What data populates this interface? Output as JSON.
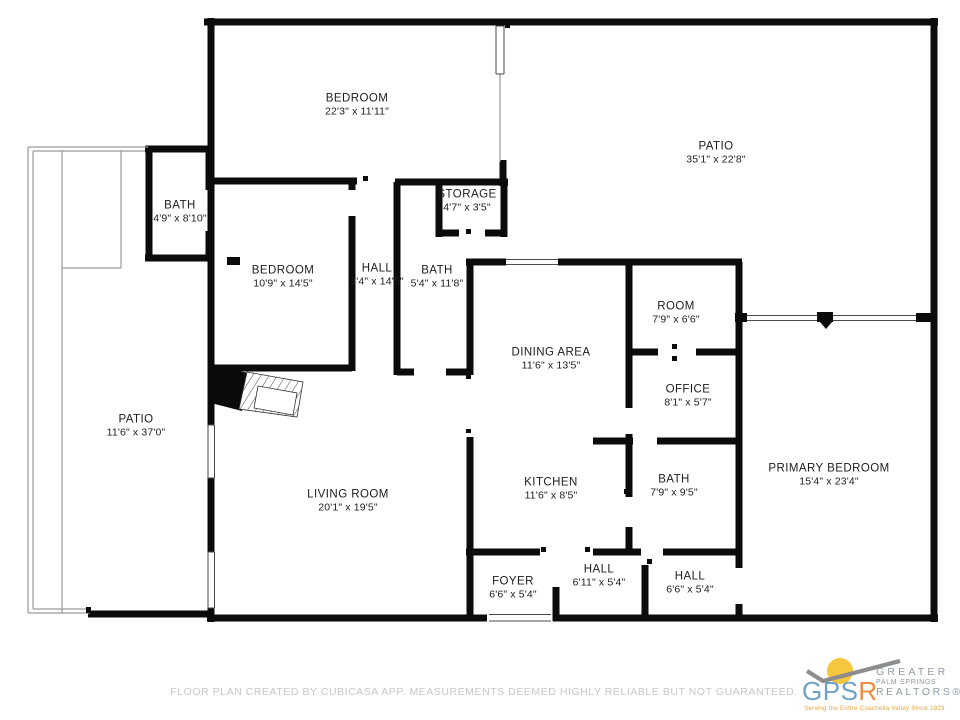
{
  "rooms": [
    {
      "name": "BEDROOM",
      "dims": "22'3\" x 11'11\""
    },
    {
      "name": "PATIO",
      "dims": "35'1\" x 22'8\""
    },
    {
      "name": "BATH",
      "dims": "4'9\" x 8'10\""
    },
    {
      "name": "STORAGE",
      "dims": "4'7\" x 3'5\""
    },
    {
      "name": "BEDROOM",
      "dims": "10'9\" x 14'5\""
    },
    {
      "name": "HALL",
      "dims": "3'4\" x 14'5\""
    },
    {
      "name": "BATH",
      "dims": "5'4\" x 11'8\""
    },
    {
      "name": "DINING AREA",
      "dims": "11'6\" x 13'5\""
    },
    {
      "name": "ROOM",
      "dims": "7'9\" x 6'6\""
    },
    {
      "name": "OFFICE",
      "dims": "8'1\" x 5'7\""
    },
    {
      "name": "PATIO",
      "dims": "11'6\" x 37'0\""
    },
    {
      "name": "LIVING ROOM",
      "dims": "20'1\" x 19'5\""
    },
    {
      "name": "KITCHEN",
      "dims": "11'6\" x 8'5\""
    },
    {
      "name": "BATH",
      "dims": "7'9\" x 9'5\""
    },
    {
      "name": "PRIMARY BEDROOM",
      "dims": "15'4\" x 23'4\""
    },
    {
      "name": "FOYER",
      "dims": "6'6\" x 5'4\""
    },
    {
      "name": "HALL",
      "dims": "6'11\" x 5'4\""
    },
    {
      "name": "HALL",
      "dims": "6'6\" x 5'4\""
    }
  ],
  "footer": {
    "disclaimer": "FLOOR PLAN CREATED BY CUBICASA APP. MEASUREMENTS DEEMED HIGHLY RELIABLE BUT NOT GUARANTEED."
  },
  "logo": {
    "acronym_gps": "GPS",
    "acronym_r": "R",
    "line1": "GREATER",
    "line2": "PALM SPRINGS",
    "line3": "REALTORS®",
    "tagline": "Serving the Entire Coachella Valley Since 1929"
  },
  "colors": {
    "wall": "#0b0b0b",
    "thin_line": "#9a9a9a",
    "label_text": "#1d1d1d",
    "footer_text": "#c7c7c7",
    "logo_blue": "#6ea3c9",
    "logo_orange": "#f08a3c",
    "logo_gray_text": "#8d9aa2",
    "sun_yellow": "#f6c63d",
    "swoosh_gray": "#8d8d8d",
    "tagline_orange": "#e9a43e"
  }
}
